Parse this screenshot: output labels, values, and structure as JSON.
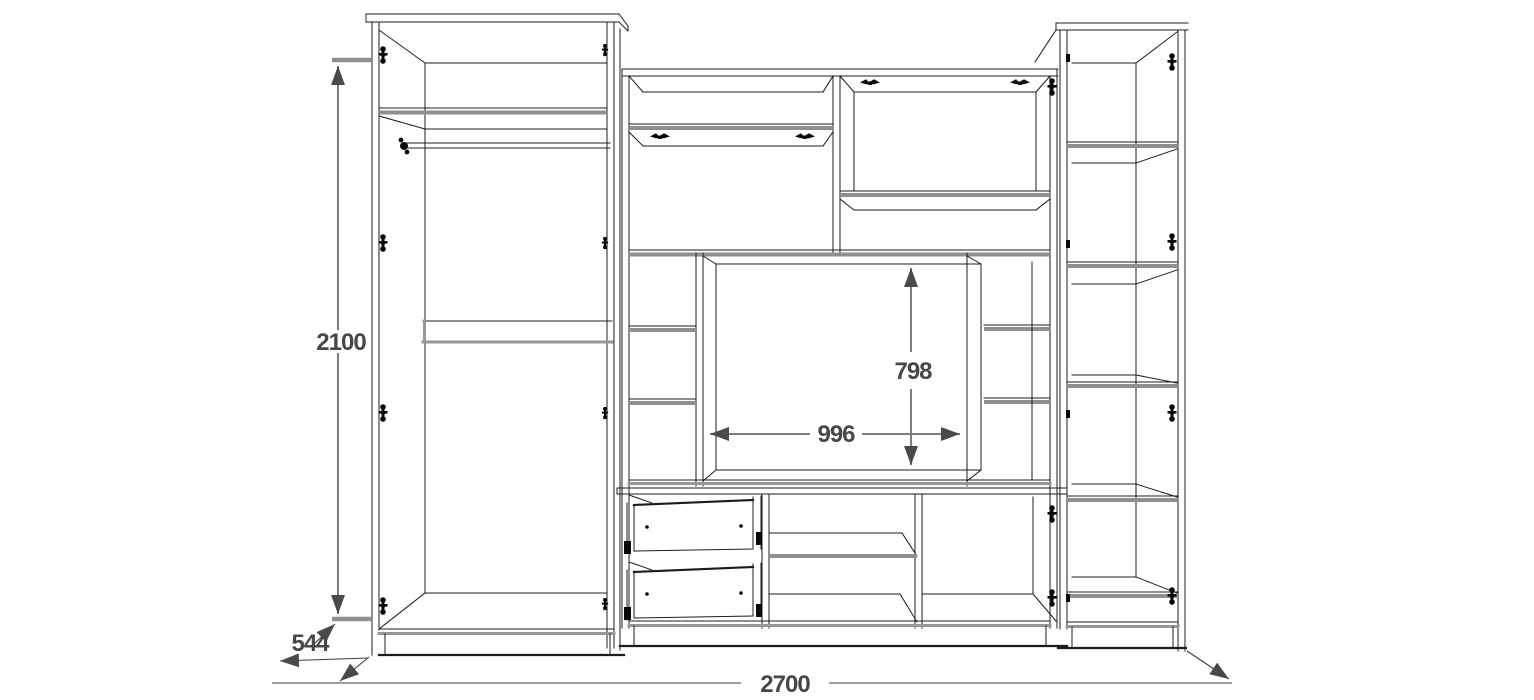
{
  "diagram": {
    "kind": "furniture technical drawing",
    "dimension_labels": {
      "overall_height": "2100",
      "depth": "544",
      "overall_width": "2700",
      "tv_niche_height": "798",
      "tv_niche_width": "996"
    },
    "colors": {
      "background": "#ffffff",
      "line": "#1c1c1c",
      "shelf_gray": "#8f8f8f",
      "dimension_gray": "#7d7d7d",
      "dimension_text": "#474747",
      "hardware_black": "#0a0a0a"
    }
  }
}
